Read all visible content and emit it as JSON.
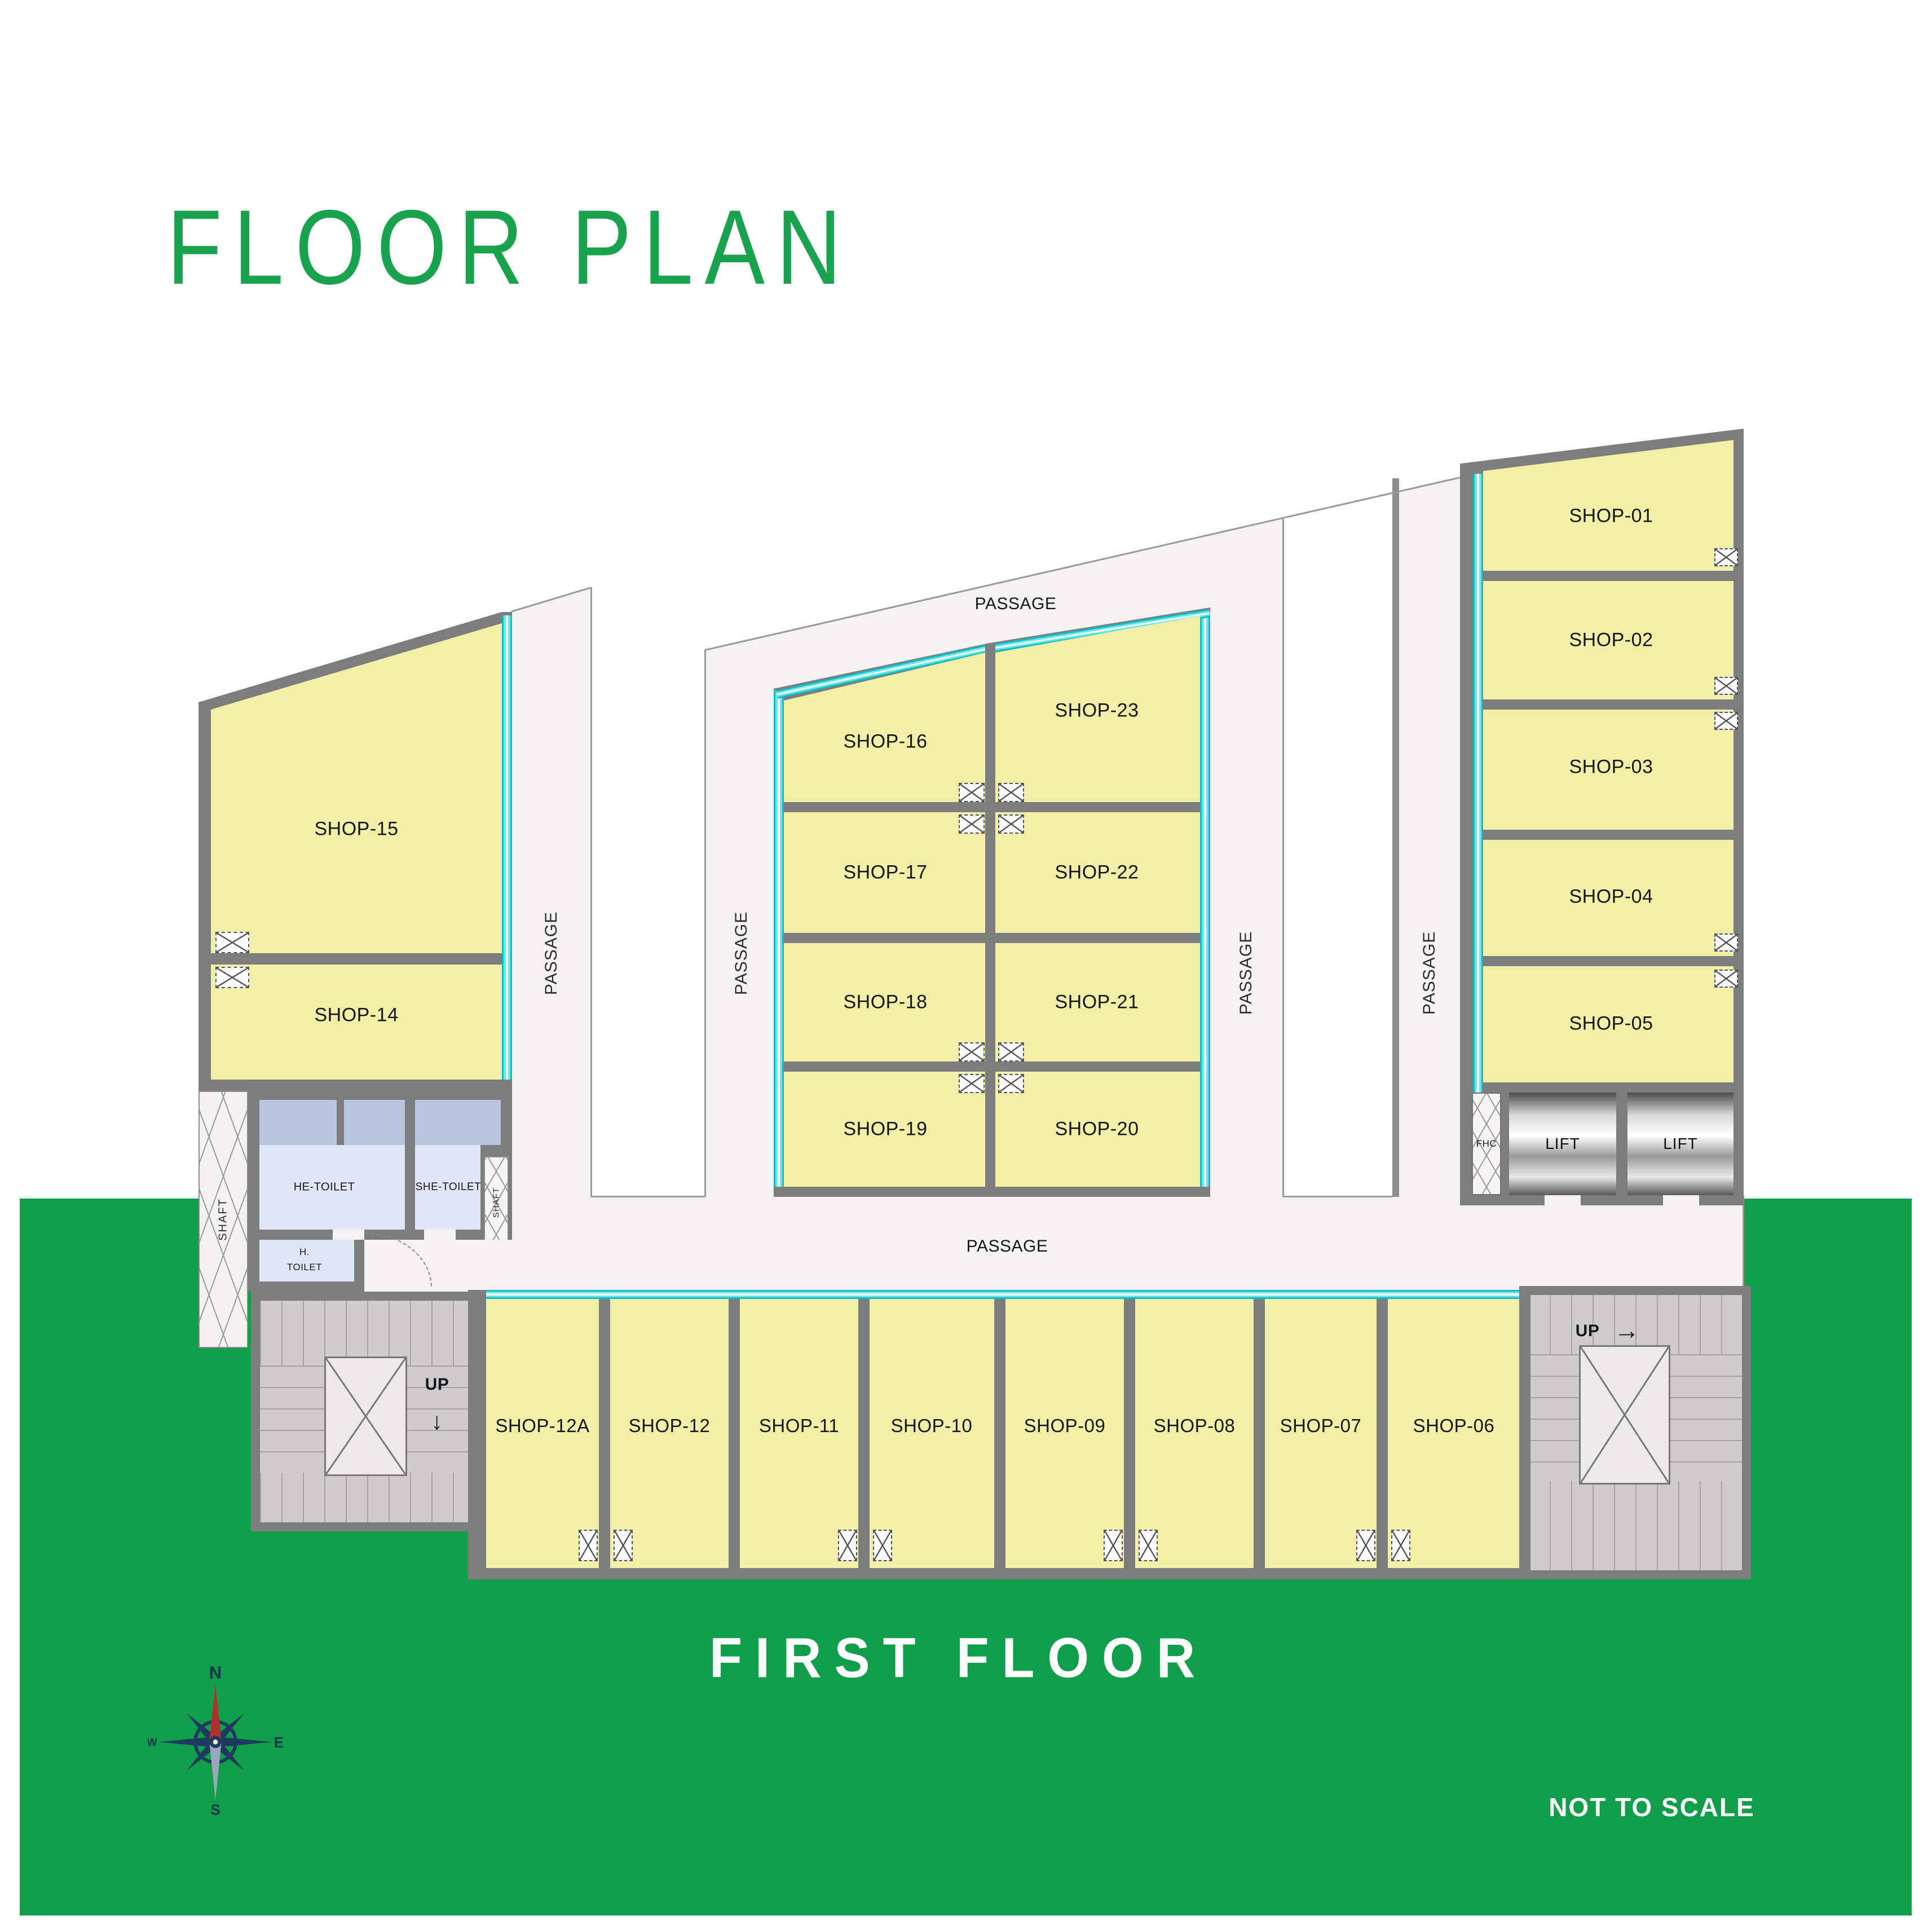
{
  "header": {
    "title": "FLOOR PLAN"
  },
  "footer": {
    "floor_label": "FIRST FLOOR",
    "scale_note": "NOT TO SCALE"
  },
  "labels": {
    "passage": "PASSAGE",
    "up": "UP",
    "lift": "LIFT",
    "shaft": "SHAFT",
    "fhc": "FHC",
    "arrow_right": "→",
    "arrow_down": "↓"
  },
  "rooms": {
    "he_toilet": "HE-TOILET",
    "she_toilet": "SHE-TOILET",
    "h_toilet_line1": "H.",
    "h_toilet_line2": "TOILET"
  },
  "shops": {
    "right_wing": [
      "SHOP-01",
      "SHOP-02",
      "SHOP-03",
      "SHOP-04",
      "SHOP-05"
    ],
    "middle_left": [
      "SHOP-16",
      "SHOP-17",
      "SHOP-18",
      "SHOP-19"
    ],
    "middle_right": [
      "SHOP-23",
      "SHOP-22",
      "SHOP-21",
      "SHOP-20"
    ],
    "left_wing": [
      "SHOP-15",
      "SHOP-14"
    ],
    "bottom_row": [
      "SHOP-12A",
      "SHOP-12",
      "SHOP-11",
      "SHOP-10",
      "SHOP-09",
      "SHOP-08",
      "SHOP-07",
      "SHOP-06"
    ]
  },
  "compass": {
    "n": "N",
    "e": "E",
    "s": "S",
    "w": "W"
  },
  "colors": {
    "accent_green": "#1AA34F",
    "background_green": "#119E4B",
    "shop_fill": "#F2EFA6",
    "wall_gray": "#7D7D7D",
    "glazing_cyan": "#45DDE4",
    "toilet_fill": "#DFE6F5",
    "stair_fill": "#CECDCB",
    "label_dark": "#15151E"
  }
}
